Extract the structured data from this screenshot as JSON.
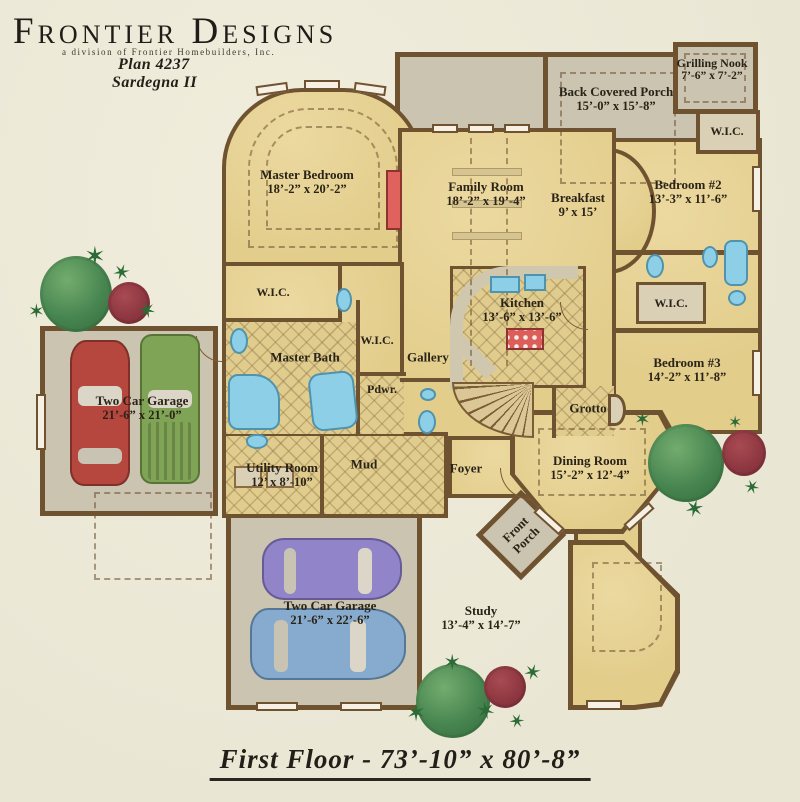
{
  "header": {
    "brand": "Frontier Designs",
    "tagline": "a division of Frontier Homebuilders, Inc.",
    "plan_number": "Plan  4237",
    "plan_name": "Sardegna II"
  },
  "footer": {
    "title": "First Floor - 73’-10”  x 80’-8”"
  },
  "rooms": {
    "master_bedroom": {
      "name": "Master Bedroom",
      "dims": "18’-2” x 20’-2”"
    },
    "family_room": {
      "name": "Family Room",
      "dims": "18’-2” x 19’-4”"
    },
    "breakfast": {
      "name": "Breakfast",
      "dims": "9’ x 15’"
    },
    "back_porch": {
      "name": "Back Covered Porch",
      "dims": "15’-0” x 15’-8”"
    },
    "grilling_nook": {
      "name": "Grilling Nook",
      "dims": "7’-6” x 7’-2”"
    },
    "wic_top_right": {
      "name": "W.I.C."
    },
    "bedroom_2": {
      "name": "Bedroom #2",
      "dims": "13’-3” x 11’-6”"
    },
    "wic_right": {
      "name": "W.I.C."
    },
    "bedroom_3": {
      "name": "Bedroom #3",
      "dims": "14’-2” x 11’-8”"
    },
    "wic_master": {
      "name": "W.I.C."
    },
    "master_bath": {
      "name": "Master Bath"
    },
    "wic_mid": {
      "name": "W.I.C."
    },
    "gallery": {
      "name": "Gallery"
    },
    "powder": {
      "name": "Pdwr."
    },
    "kitchen": {
      "name": "Kitchen",
      "dims": "13’-6” x 13’-6”"
    },
    "grotto": {
      "name": "Grotto"
    },
    "garage_left": {
      "name": "Two Car Garage",
      "dims": "21’-6” x 21’-0”"
    },
    "utility": {
      "name": "Utility Room",
      "dims": "12’ x 8’-10”"
    },
    "mud": {
      "name": "Mud"
    },
    "foyer": {
      "name": "Foyer"
    },
    "dining": {
      "name": "Dining Room",
      "dims": "15’-2” x 12’-4”"
    },
    "front_porch": {
      "name": "Front Porch"
    },
    "garage_bottom": {
      "name": "Two Car Garage",
      "dims": "21’-6” x 22’-6”"
    },
    "study": {
      "name": "Study",
      "dims": "13’-4” x 14’-7”"
    }
  },
  "icons": {
    "palm_glyph": "✶"
  },
  "colors": {
    "background": "#eae6d4",
    "floor_gold": "#e2cd8b",
    "wall_brown": "#6f5230",
    "porch_gray": "#cbc4b1",
    "fixture_blue": "#8ecfe8",
    "accent_red": "#db5f58",
    "tree_green": "#478550",
    "bush_red": "#8c3640",
    "car_red": "#b5473e",
    "car_green": "#80a455",
    "car_purple": "#9184c8",
    "car_blue": "#86abce"
  }
}
